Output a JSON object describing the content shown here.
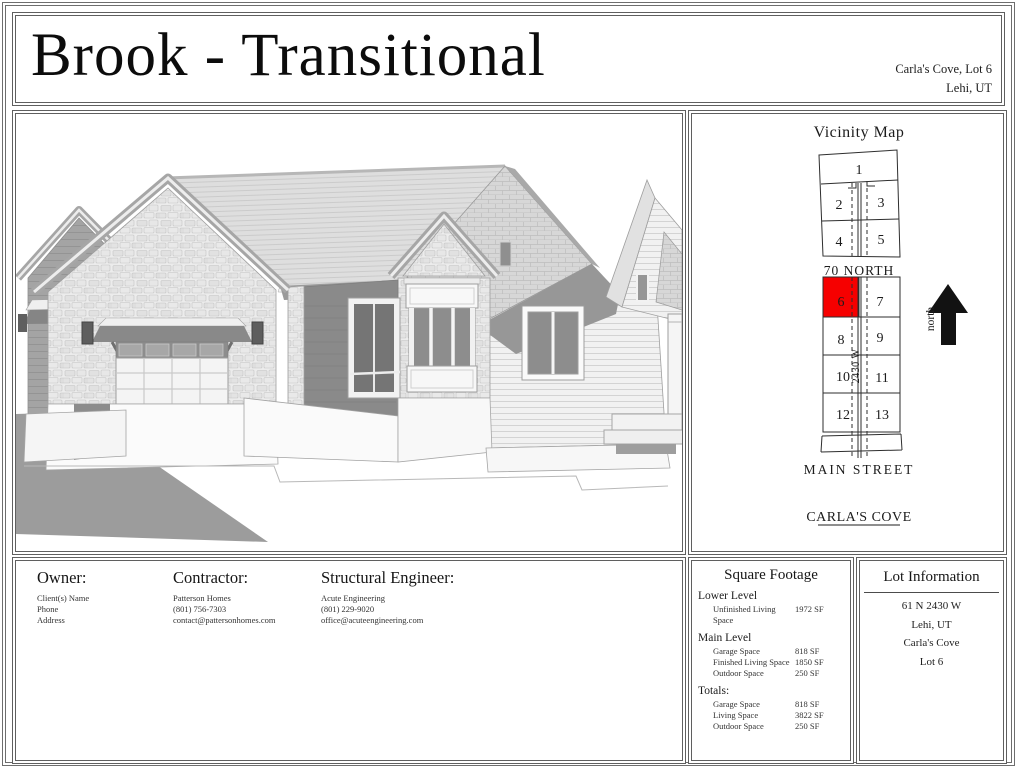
{
  "title_block": {
    "plan_name": "Brook - Transitional",
    "project": "Carla's Cove, Lot 6",
    "city_state": "Lehi, UT"
  },
  "vicinity_map": {
    "title": "Vicinity Map",
    "upper_block_lots": [
      [
        "1"
      ],
      [
        "2",
        "3"
      ],
      [
        "4",
        "5"
      ]
    ],
    "lower_block_lots": [
      [
        "6",
        "7"
      ],
      [
        "8",
        "9"
      ],
      [
        "10",
        "11"
      ],
      [
        "12",
        "13"
      ]
    ],
    "highlighted_lot": "6",
    "highlight_color": "#f60000",
    "street_top": "70 NORTH",
    "street_bottom": "MAIN STREET",
    "road_label": "2430 W",
    "subdivision_label": "CARLA'S COVE",
    "compass_label": "north"
  },
  "contacts": {
    "owner": {
      "heading": "Owner:",
      "lines": [
        "Client(s) Name",
        "Phone",
        "Address"
      ]
    },
    "contractor": {
      "heading": "Contractor:",
      "lines": [
        "Patterson Homes",
        "(801) 756-7303",
        "contact@pattersonhomes.com"
      ]
    },
    "engineer": {
      "heading": "Structural Engineer:",
      "lines": [
        "Acute Engineering",
        "(801) 229-9020",
        "office@acuteengineering.com"
      ]
    }
  },
  "square_footage": {
    "title": "Square Footage",
    "sections": [
      {
        "heading": "Lower Level",
        "rows": [
          {
            "label": "Unfinished Living Space",
            "value": "1972 SF"
          }
        ]
      },
      {
        "heading": "Main Level",
        "rows": [
          {
            "label": "Garage Space",
            "value": "818 SF"
          },
          {
            "label": "Finished Living Space",
            "value": "1850 SF"
          },
          {
            "label": "Outdoor Space",
            "value": "250 SF"
          }
        ]
      },
      {
        "heading": "Totals:",
        "rows": [
          {
            "label": "Garage Space",
            "value": "818 SF"
          },
          {
            "label": "Living Space",
            "value": "3822 SF"
          },
          {
            "label": "Outdoor Space",
            "value": "250 SF"
          }
        ]
      }
    ]
  },
  "lot_information": {
    "title": "Lot Information",
    "lines": [
      "61 N 2430 W",
      "Lehi, UT",
      "Carla's Cove",
      "Lot 6"
    ]
  }
}
